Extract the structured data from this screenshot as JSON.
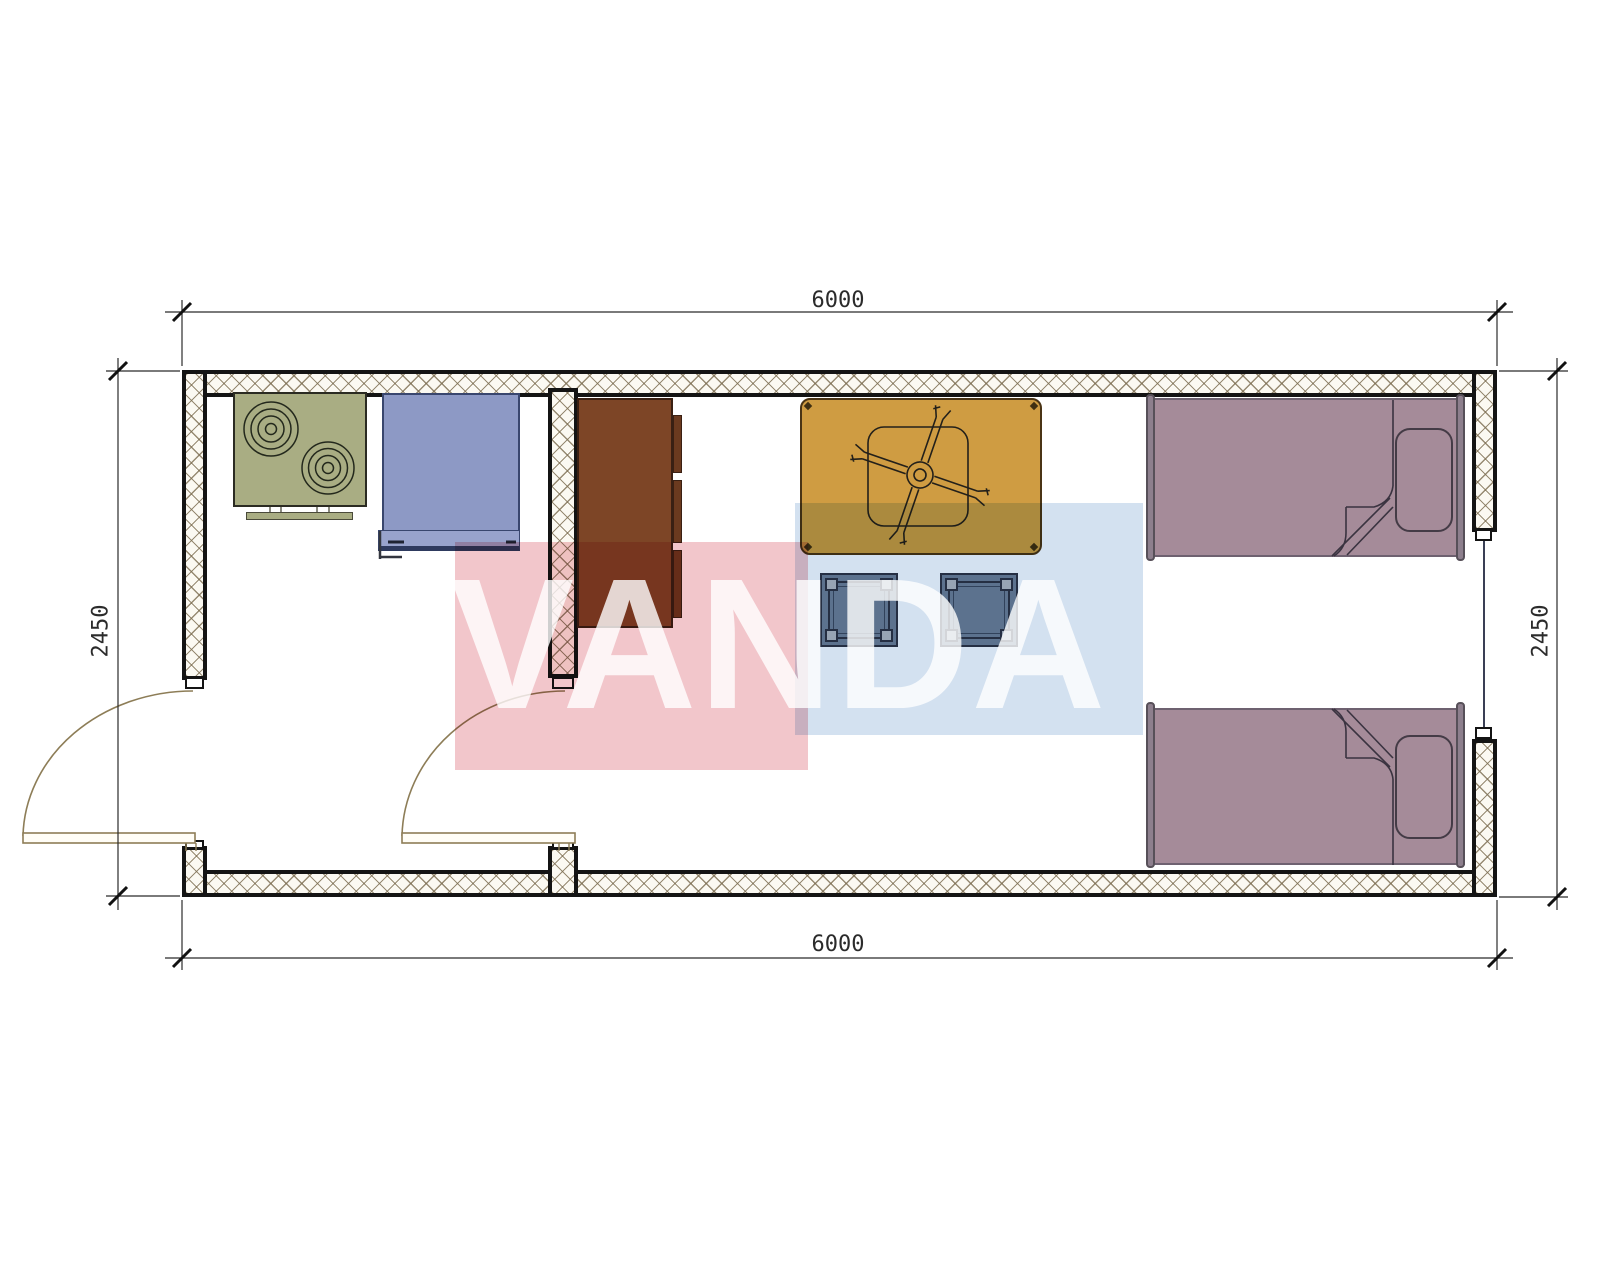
{
  "page": {
    "background": "#ffffff",
    "type": "architectural floor plan drawing"
  },
  "dimensions": {
    "top": {
      "label": "6000"
    },
    "bottom": {
      "label": "6000"
    },
    "left": {
      "label": "2450"
    },
    "right": {
      "label": "2450"
    }
  },
  "watermark": {
    "text": "VANDA",
    "red_square_color": "#f2c6cb",
    "blue_square_color": "#d3e1f0",
    "text_color": "rgba(255,255,255,0.8)"
  },
  "plan": {
    "wall_colors": {
      "outline": "#141414",
      "hatch_line": "#7d6e52",
      "hatch_fill": "#fbf9f2"
    },
    "dimension_color": "#2b2b2b",
    "door_color": "#8d7d57",
    "furniture": [
      {
        "name": "cooktop-stove",
        "color": "#a9ad83",
        "count": 1
      },
      {
        "name": "sink",
        "color": "#8d99c5",
        "count": 1
      },
      {
        "name": "wardrobe-cabinet",
        "color": "#7d4526",
        "count": 1
      },
      {
        "name": "dining-table",
        "color": "#cf9c42",
        "count": 1
      },
      {
        "name": "ceiling-fan",
        "color": "#23201a",
        "count": 1
      },
      {
        "name": "stool",
        "color": "#6f8197",
        "count": 2
      },
      {
        "name": "single-bed",
        "color": "#a58b99",
        "count": 2
      }
    ],
    "openings": [
      {
        "name": "entrance-door",
        "wall": "left"
      },
      {
        "name": "interior-door",
        "wall": "partition"
      },
      {
        "name": "window",
        "wall": "right"
      }
    ]
  }
}
